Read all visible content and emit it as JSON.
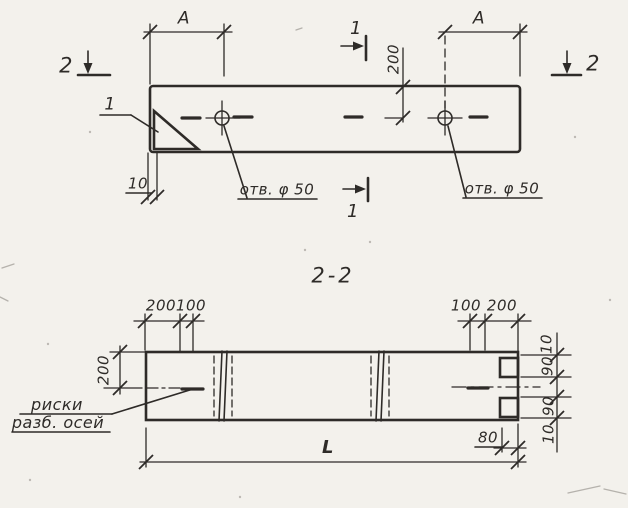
{
  "colors": {
    "ink": "#2e2b28",
    "paper": "#f3f1ec"
  },
  "top_view": {
    "dim_a_left": "A",
    "dim_a_right": "A",
    "dim_200": "200",
    "dim_10": "10",
    "hole_left_label": "отв. φ 50",
    "hole_right_label": "отв. φ 50",
    "callout_1": "1",
    "section_1_top": "1",
    "section_1_bottom": "1",
    "section_2_left": "2",
    "section_2_right": "2"
  },
  "section_view": {
    "title": "2-2",
    "top_left_dims": [
      "200",
      "100"
    ],
    "top_right_dims": [
      "100",
      "200"
    ],
    "left_dim": "200",
    "right_dims": [
      "10",
      "90",
      "90",
      "10"
    ],
    "bottom_dims": {
      "offset": "80",
      "length": "L"
    },
    "axes_label": {
      "line1": "риски",
      "line2": "разб. осей"
    }
  }
}
